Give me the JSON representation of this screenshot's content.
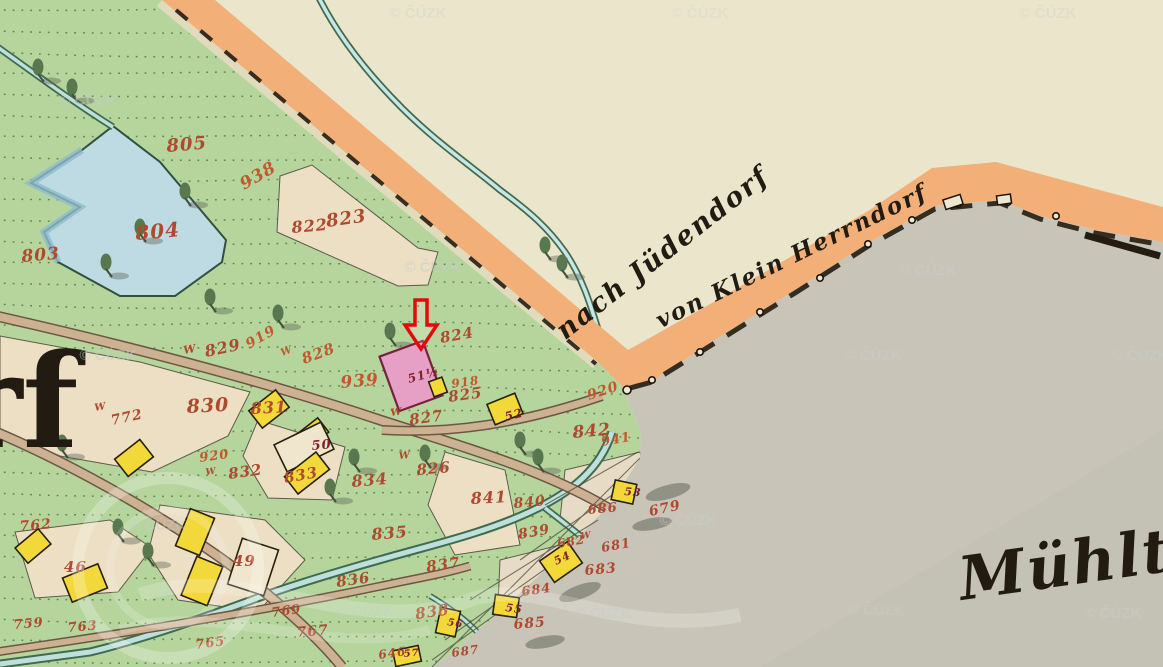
{
  "map": {
    "type": "historical-cadastral-map",
    "watermark": {
      "text": "© ČÚZK",
      "color": "#c6cdcc",
      "positions": [
        {
          "x": 418,
          "y": 13,
          "o": 0.28
        },
        {
          "x": 700,
          "y": 13,
          "o": 0.22
        },
        {
          "x": 1048,
          "y": 13,
          "o": 0.28
        },
        {
          "x": 88,
          "y": 100,
          "o": 0.5
        },
        {
          "x": 433,
          "y": 267,
          "o": 0.45
        },
        {
          "x": 928,
          "y": 270,
          "o": 0.45
        },
        {
          "x": 108,
          "y": 355,
          "o": 0.5
        },
        {
          "x": 873,
          "y": 355,
          "o": 0.45
        },
        {
          "x": 1140,
          "y": 355,
          "o": 0.5
        },
        {
          "x": 158,
          "y": 525,
          "o": 0.4
        },
        {
          "x": 688,
          "y": 520,
          "o": 0.45
        },
        {
          "x": 365,
          "y": 611,
          "o": 0.4
        },
        {
          "x": 603,
          "y": 613,
          "o": 0.45
        },
        {
          "x": 876,
          "y": 610,
          "o": 0.45
        },
        {
          "x": 1113,
          "y": 613,
          "o": 0.5
        }
      ]
    },
    "place_labels": [
      {
        "text": "nach Jüdendorf",
        "x": 668,
        "y": 260,
        "rot": -38,
        "size": 27
      },
      {
        "text": "von Klein Herrndorf",
        "x": 795,
        "y": 263,
        "rot": -26,
        "size": 23
      },
      {
        "text": "Mühlte",
        "x": 962,
        "y": 600,
        "rot": -8,
        "size": 60,
        "anchor": "start"
      },
      {
        "text": "rf",
        "x": -46,
        "y": 447,
        "rot": 0,
        "size": 130,
        "anchor": "start",
        "upright": true
      }
    ],
    "annotation_arrow": {
      "meaning": "highlight of house 51 1/2",
      "color": "#e10b0b",
      "points": "415,300 427,300 427,325 437,325 421,349 405,325 415,325"
    },
    "parcel_labels": [
      {
        "t": "803",
        "x": 22,
        "y": 262,
        "r": -5,
        "s": 17
      },
      {
        "t": "804",
        "x": 136,
        "y": 240,
        "r": -5,
        "s": 20
      },
      {
        "t": "805",
        "x": 167,
        "y": 152,
        "r": -5,
        "s": 18
      },
      {
        "t": "938",
        "x": 244,
        "y": 190,
        "r": -30,
        "s": 17,
        "c": "orange"
      },
      {
        "t": "822",
        "x": 292,
        "y": 233,
        "r": -5,
        "s": 16
      },
      {
        "t": "823",
        "x": 327,
        "y": 227,
        "r": -8,
        "s": 18
      },
      {
        "t": "W",
        "x": 184,
        "y": 354,
        "r": -10,
        "s": 11
      },
      {
        "t": "829",
        "x": 206,
        "y": 357,
        "r": -12,
        "s": 16
      },
      {
        "t": "919",
        "x": 249,
        "y": 349,
        "r": -30,
        "s": 14,
        "c": "orange"
      },
      {
        "t": "W",
        "x": 282,
        "y": 356,
        "r": -20,
        "s": 10,
        "c": "orange"
      },
      {
        "t": "828",
        "x": 304,
        "y": 364,
        "r": -20,
        "s": 15,
        "c": "orange"
      },
      {
        "t": "939",
        "x": 341,
        "y": 388,
        "r": -5,
        "s": 17,
        "c": "orange"
      },
      {
        "t": "830",
        "x": 187,
        "y": 413,
        "r": -3,
        "s": 19
      },
      {
        "t": "831",
        "x": 251,
        "y": 414,
        "r": -3,
        "s": 16
      },
      {
        "t": "824",
        "x": 441,
        "y": 343,
        "r": -10,
        "s": 15
      },
      {
        "t": "918",
        "x": 452,
        "y": 388,
        "r": -8,
        "s": 12,
        "c": "orange"
      },
      {
        "t": "825",
        "x": 449,
        "y": 402,
        "r": -8,
        "s": 15
      },
      {
        "t": "W",
        "x": 391,
        "y": 416,
        "r": -8,
        "s": 10
      },
      {
        "t": "827",
        "x": 410,
        "y": 425,
        "r": -8,
        "s": 15
      },
      {
        "t": "W",
        "x": 399,
        "y": 459,
        "r": -5,
        "s": 10
      },
      {
        "t": "826",
        "x": 417,
        "y": 475,
        "r": -5,
        "s": 15
      },
      {
        "t": "920",
        "x": 200,
        "y": 462,
        "r": -8,
        "s": 13,
        "c": "orange"
      },
      {
        "t": "W",
        "x": 206,
        "y": 475,
        "r": -8,
        "s": 9
      },
      {
        "t": "832",
        "x": 229,
        "y": 479,
        "r": -8,
        "s": 15
      },
      {
        "t": "833",
        "x": 285,
        "y": 483,
        "r": -10,
        "s": 15
      },
      {
        "t": "834",
        "x": 352,
        "y": 487,
        "r": -5,
        "s": 16
      },
      {
        "t": "835",
        "x": 372,
        "y": 540,
        "r": -5,
        "s": 16
      },
      {
        "t": "836",
        "x": 337,
        "y": 587,
        "r": -8,
        "s": 15
      },
      {
        "t": "837",
        "x": 427,
        "y": 572,
        "r": -8,
        "s": 15
      },
      {
        "t": "838",
        "x": 416,
        "y": 619,
        "r": -8,
        "s": 15
      },
      {
        "t": "839",
        "x": 519,
        "y": 539,
        "r": -10,
        "s": 14
      },
      {
        "t": "840",
        "x": 514,
        "y": 508,
        "r": -5,
        "s": 14
      },
      {
        "t": "841",
        "x": 471,
        "y": 504,
        "r": -3,
        "s": 16
      },
      {
        "t": "842",
        "x": 573,
        "y": 438,
        "r": -5,
        "s": 17
      },
      {
        "t": "920",
        "x": 589,
        "y": 400,
        "r": -18,
        "s": 14,
        "c": "orange"
      },
      {
        "t": "941",
        "x": 602,
        "y": 446,
        "r": -10,
        "s": 13,
        "c": "orange"
      },
      {
        "t": "686",
        "x": 588,
        "y": 514,
        "r": -5,
        "s": 13
      },
      {
        "t": "679",
        "x": 650,
        "y": 516,
        "r": -12,
        "s": 14
      },
      {
        "t": "682",
        "x": 558,
        "y": 548,
        "r": -10,
        "s": 12
      },
      {
        "t": "W",
        "x": 581,
        "y": 539,
        "r": -8,
        "s": 9
      },
      {
        "t": "681",
        "x": 602,
        "y": 552,
        "r": -10,
        "s": 13
      },
      {
        "t": "683",
        "x": 585,
        "y": 575,
        "r": -5,
        "s": 14
      },
      {
        "t": "684",
        "x": 522,
        "y": 596,
        "r": -8,
        "s": 13
      },
      {
        "t": "685",
        "x": 514,
        "y": 629,
        "r": -5,
        "s": 14
      },
      {
        "t": "687",
        "x": 452,
        "y": 657,
        "r": -8,
        "s": 12
      },
      {
        "t": "646",
        "x": 379,
        "y": 659,
        "r": -8,
        "s": 12
      },
      {
        "t": "762",
        "x": 20,
        "y": 531,
        "r": -5,
        "s": 14
      },
      {
        "t": "759",
        "x": 14,
        "y": 629,
        "r": -5,
        "s": 13
      },
      {
        "t": "763",
        "x": 68,
        "y": 632,
        "r": -5,
        "s": 13
      },
      {
        "t": "765",
        "x": 196,
        "y": 649,
        "r": -8,
        "s": 13
      },
      {
        "t": "769",
        "x": 272,
        "y": 617,
        "r": -8,
        "s": 13
      },
      {
        "t": "767",
        "x": 297,
        "y": 637,
        "r": -5,
        "s": 14
      },
      {
        "t": "W",
        "x": 95,
        "y": 411,
        "r": -10,
        "s": 10
      },
      {
        "t": "772",
        "x": 112,
        "y": 425,
        "r": -12,
        "s": 14
      },
      {
        "t": "46",
        "x": 64,
        "y": 572,
        "r": 0,
        "s": 15
      },
      {
        "t": "49",
        "x": 233,
        "y": 566,
        "r": 0,
        "s": 15
      },
      {
        "t": "50",
        "x": 312,
        "y": 450,
        "r": -5,
        "s": 13,
        "c": "dark"
      },
      {
        "t": "51½",
        "x": 409,
        "y": 383,
        "r": -15,
        "s": 12,
        "c": "dark"
      },
      {
        "t": "52",
        "x": 506,
        "y": 421,
        "r": -15,
        "s": 12,
        "c": "dark"
      },
      {
        "t": "53",
        "x": 624,
        "y": 495,
        "r": 5,
        "s": 11,
        "c": "dark"
      },
      {
        "t": "54",
        "x": 556,
        "y": 565,
        "r": -25,
        "s": 11,
        "c": "dark"
      },
      {
        "t": "55",
        "x": 505,
        "y": 611,
        "r": 8,
        "s": 11,
        "c": "dark"
      },
      {
        "t": "56",
        "x": 447,
        "y": 625,
        "r": 10,
        "s": 10,
        "c": "dark"
      },
      {
        "t": "57",
        "x": 404,
        "y": 657,
        "r": -5,
        "s": 10,
        "c": "dark"
      }
    ],
    "buildings": [
      {
        "x": 252,
        "y": 398,
        "w": 34,
        "h": 22,
        "r": -38,
        "t": "y"
      },
      {
        "x": 300,
        "y": 424,
        "w": 26,
        "h": 18,
        "r": -38,
        "t": "y"
      },
      {
        "x": 278,
        "y": 432,
        "w": 52,
        "h": 30,
        "r": -26,
        "t": "b"
      },
      {
        "x": 287,
        "y": 462,
        "w": 40,
        "h": 22,
        "r": -38,
        "t": "y"
      },
      {
        "x": 118,
        "y": 447,
        "w": 32,
        "h": 22,
        "r": -38,
        "t": "y"
      },
      {
        "x": 18,
        "y": 536,
        "w": 30,
        "h": 20,
        "r": -40,
        "t": "y"
      },
      {
        "x": 66,
        "y": 570,
        "w": 38,
        "h": 26,
        "r": -22,
        "t": "y"
      },
      {
        "x": 182,
        "y": 512,
        "w": 26,
        "h": 40,
        "r": 22,
        "t": "y"
      },
      {
        "x": 188,
        "y": 560,
        "w": 28,
        "h": 42,
        "r": 22,
        "t": "y"
      },
      {
        "x": 234,
        "y": 543,
        "w": 38,
        "h": 48,
        "r": 18,
        "t": "b"
      },
      {
        "x": 490,
        "y": 398,
        "w": 30,
        "h": 22,
        "r": -22,
        "t": "y"
      },
      {
        "x": 613,
        "y": 482,
        "w": 22,
        "h": 20,
        "r": 12,
        "t": "y"
      },
      {
        "x": 544,
        "y": 549,
        "w": 34,
        "h": 26,
        "r": -35,
        "t": "y"
      },
      {
        "x": 494,
        "y": 596,
        "w": 24,
        "h": 20,
        "r": 8,
        "t": "y"
      },
      {
        "x": 438,
        "y": 609,
        "w": 20,
        "h": 26,
        "r": 12,
        "t": "y"
      },
      {
        "x": 394,
        "y": 648,
        "w": 26,
        "h": 16,
        "r": -12,
        "t": "y"
      },
      {
        "x": 388,
        "y": 347,
        "w": 46,
        "h": 58,
        "r": -20,
        "t": "p"
      },
      {
        "x": 431,
        "y": 379,
        "w": 14,
        "h": 16,
        "r": -20,
        "t": "y"
      },
      {
        "x": 944,
        "y": 197,
        "w": 18,
        "h": 10,
        "r": -18,
        "t": "w"
      },
      {
        "x": 997,
        "y": 195,
        "w": 14,
        "h": 9,
        "r": -8,
        "t": "w"
      }
    ],
    "trees": [
      {
        "x": 38,
        "y": 72
      },
      {
        "x": 72,
        "y": 92
      },
      {
        "x": 140,
        "y": 232
      },
      {
        "x": 106,
        "y": 267
      },
      {
        "x": 185,
        "y": 196
      },
      {
        "x": 210,
        "y": 302
      },
      {
        "x": 278,
        "y": 318
      },
      {
        "x": 390,
        "y": 336
      },
      {
        "x": 354,
        "y": 462
      },
      {
        "x": 425,
        "y": 458
      },
      {
        "x": 545,
        "y": 250
      },
      {
        "x": 562,
        "y": 268
      },
      {
        "x": 520,
        "y": 445
      },
      {
        "x": 538,
        "y": 462
      },
      {
        "x": 118,
        "y": 532
      },
      {
        "x": 148,
        "y": 556
      },
      {
        "x": 62,
        "y": 448
      },
      {
        "x": 330,
        "y": 492
      }
    ],
    "smudges": [
      {
        "x": 668,
        "y": 492,
        "w": 46,
        "h": 14,
        "r": -15
      },
      {
        "x": 652,
        "y": 524,
        "w": 40,
        "h": 12,
        "r": -10
      },
      {
        "x": 580,
        "y": 592,
        "w": 44,
        "h": 14,
        "r": -20
      },
      {
        "x": 545,
        "y": 642,
        "w": 40,
        "h": 12,
        "r": -10
      }
    ],
    "colors": {
      "paper": "#eae5cb",
      "meadow": "#b5d59d",
      "road_band": "#f2b078",
      "water": "#c8c5b8",
      "pond": "#bedbe3",
      "field": "#ecdfc3",
      "house_yellow": "#f2d838",
      "house_beige": "#f0e6cd",
      "house_pink": "#e6a0c6",
      "number_red": "#ae4a30",
      "number_orange": "#c05a2e",
      "number_dark": "#7d2030",
      "ink": "#221b12",
      "road_fill": "#ccb193",
      "road_edge": "#6b5844"
    }
  }
}
